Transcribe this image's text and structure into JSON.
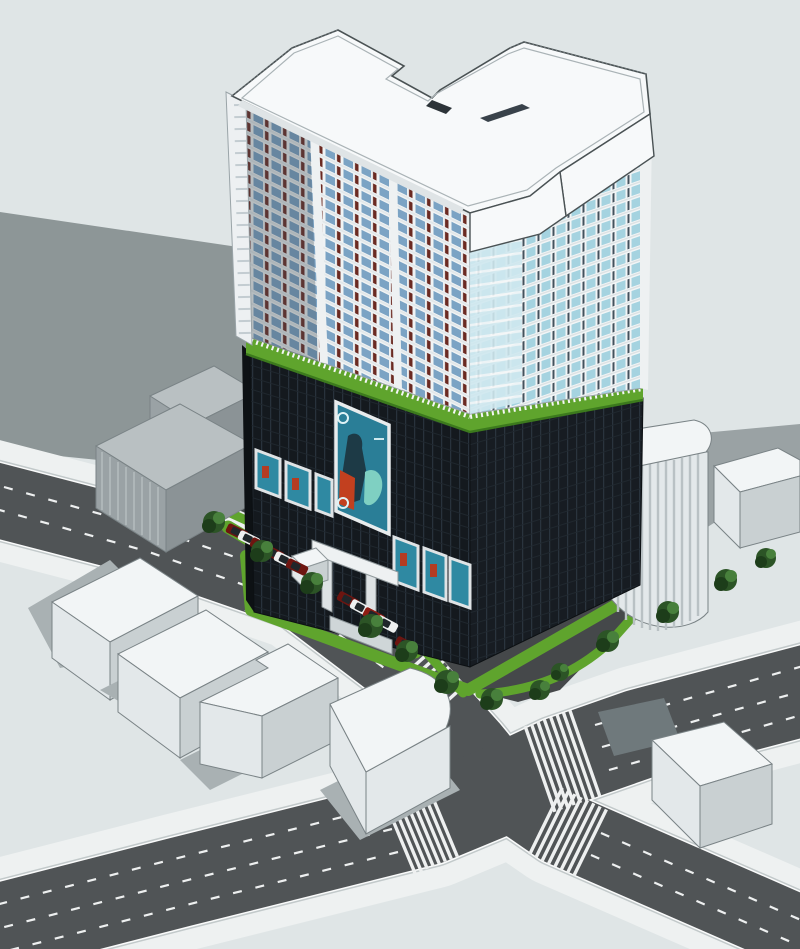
{
  "meta": {
    "description": "Aerial 3D architectural massing render of a high-rise residential tower on a dark retail podium with a green roof-garden band, fronting a four-arm street intersection with zebra crosswalks, lane dashes, parked cars, hedges, street trees and white massing models of neighboring buildings.",
    "style": "sketchup-style architectural visualization, no visible text"
  },
  "colors": {
    "background": "#dfe5e6",
    "shadow": "#8d9697",
    "shadow-soft": "#a9b1b3",
    "road": "#505456",
    "sidewalk": "#eef1f1",
    "curb": "#c2c9ca",
    "curb-white": "#fafbfb",
    "marking": "#eef0f0",
    "site-asphalt": "#45484a",
    "green": "#5fa42d",
    "green-dark": "#3c7a1d",
    "tree": "#2c5426",
    "tree-dark": "#1d3d1a",
    "tree-light": "#48803c",
    "roof": "#f7f9fa",
    "outline": "#4a5254",
    "facade-white": "#eef1f2",
    "glass-blue": "#7ba3c4",
    "glass-cyan": "#a5d3e0",
    "spandrel-red": "#6b2a22",
    "podium": "#14191e",
    "podium-line": "#29323c",
    "billboard-teal": "#2a7e97",
    "poster-teal": "#2f89a2",
    "car-red": "#8f1d14",
    "car-darkred": "#6d1510",
    "car-white": "#eef0f0",
    "car-glass": "#20262a",
    "massing-top": "#f2f5f6",
    "massing-front": "#e3e8ea",
    "massing-side": "#c9d0d2",
    "gray-top": "#b9c0c2",
    "gray-front": "#9aa2a5",
    "gray-side": "#8b9396"
  },
  "scene": {
    "tower": {
      "front_facade": "white mullion grid, blue glass, dark-red spandrel panels",
      "right_facade": "light cyan glass with curved corner balcony bays",
      "roof": "white roof decks with parapet railings and stepped terraces"
    },
    "podium": {
      "finish": "dark curtain-wall grid",
      "roof_band": "green garden strip with white balustrade",
      "billboard": "large teal advertising poster on front facade",
      "small_posters_left": 3,
      "small_posters_right": 3,
      "entrance": "white canopy with pillars and steps"
    },
    "streets": {
      "roads": 2,
      "crosswalks": 5,
      "lane_marking": "white dashed lines",
      "sidewalk": "light concrete with curbs"
    },
    "vehicles": {
      "row_a_colors": [
        "darkred",
        "white",
        "darkred",
        "darkred",
        "white",
        "darkred"
      ],
      "row_b_colors": [
        "darkred",
        "white",
        "red",
        "white",
        "darkred"
      ]
    },
    "landscape": {
      "trees": 13,
      "hedge_strips": "bright green",
      "kiosk": "small white box"
    }
  }
}
